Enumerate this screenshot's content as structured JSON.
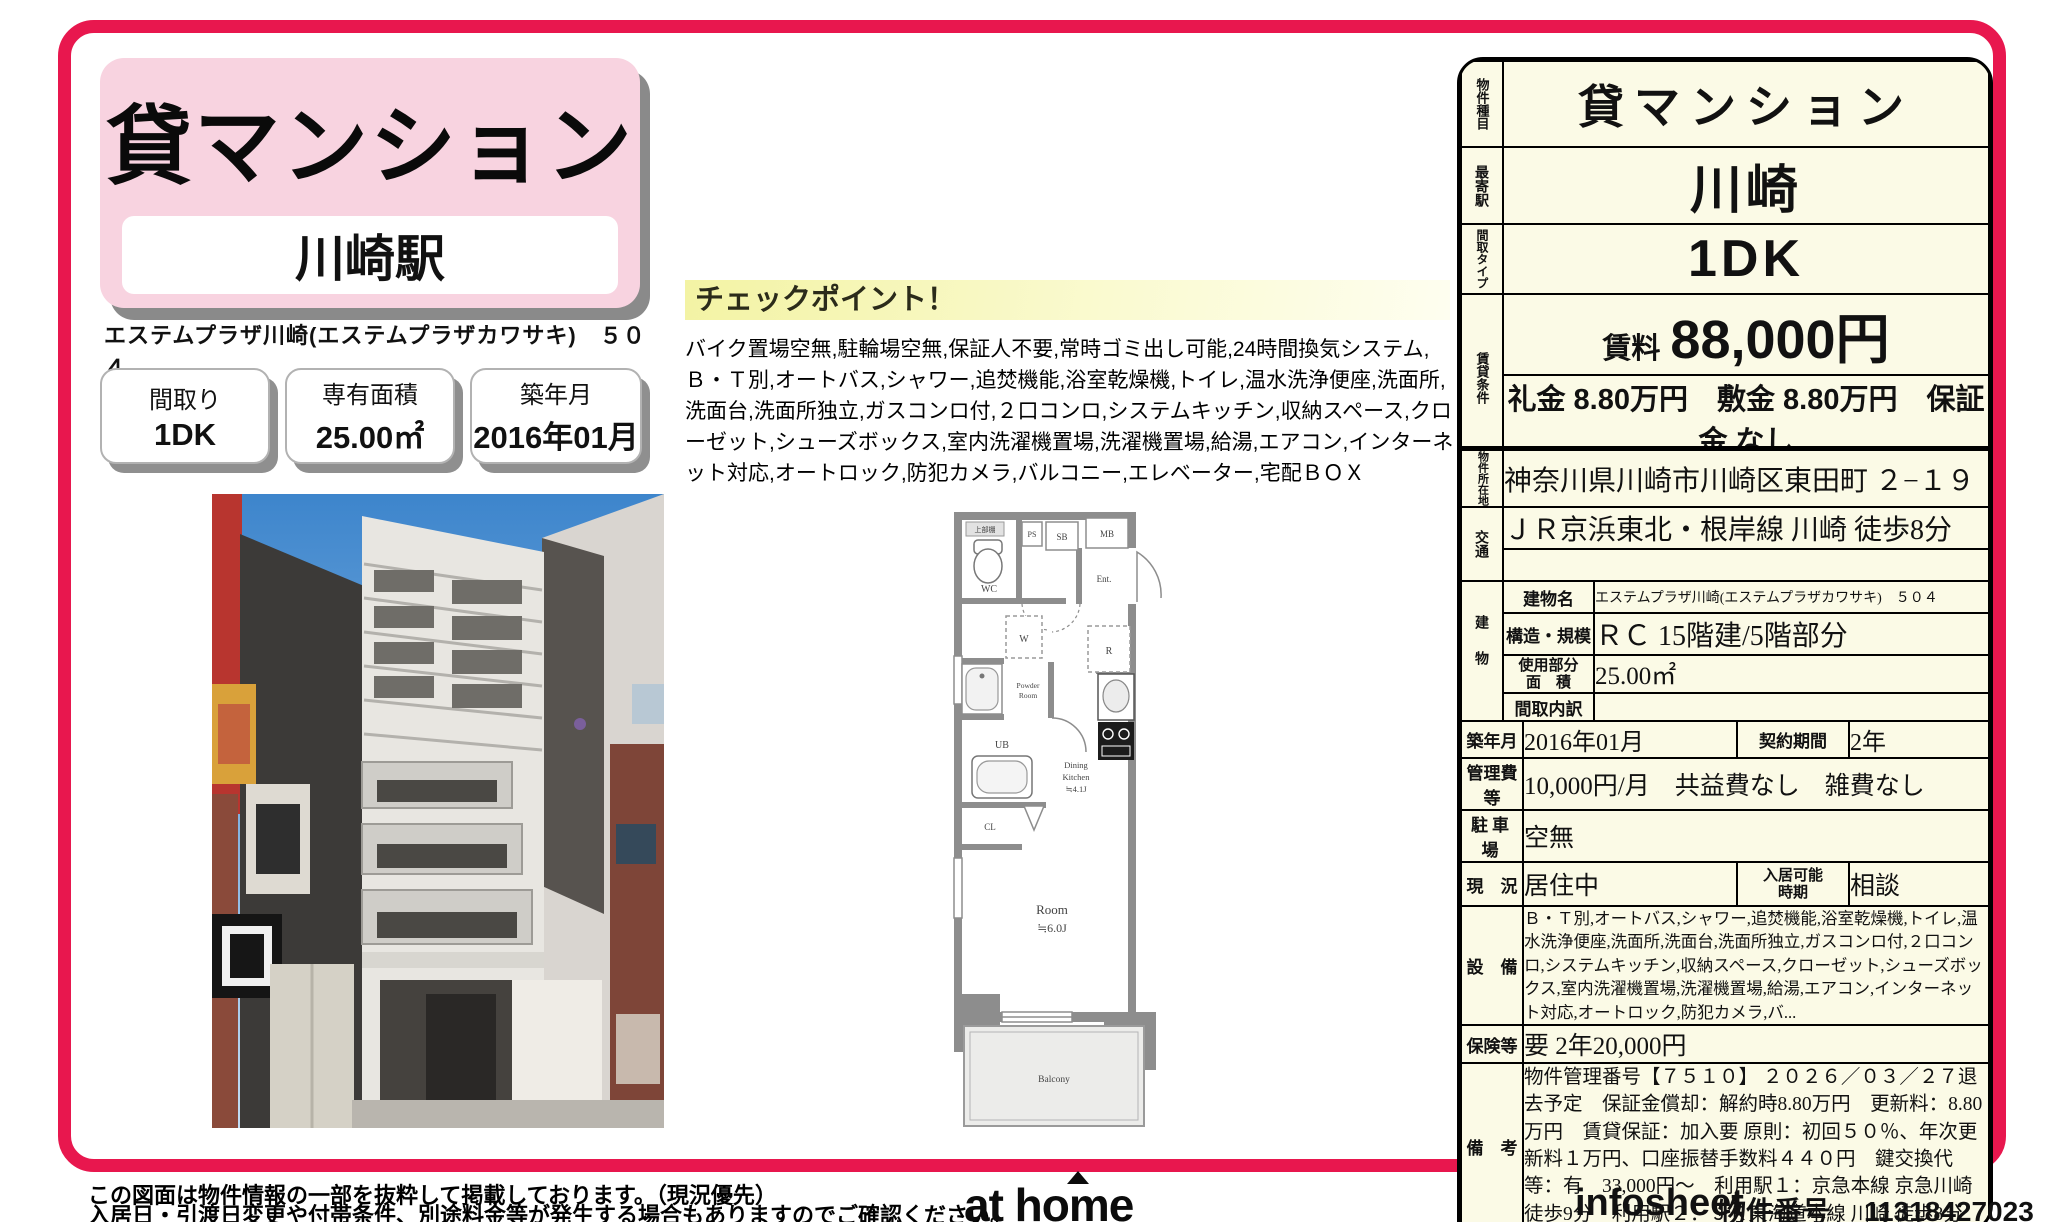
{
  "colors": {
    "accent": "#e8174e",
    "pink_card": "#f8d3e0",
    "pink_cell": "#f6cedd",
    "cream": "#fbfae6",
    "checkpoint_yellow": "#f4f4aa"
  },
  "header": {
    "property_type": "貸マンション",
    "station": "川崎駅",
    "building_name_line": "エステムプラザ川崎(エステムプラザカワサキ)　５０４"
  },
  "summary_boxes": [
    {
      "label": "間取り",
      "value": "1DK"
    },
    {
      "label": "専有面積",
      "value": "25.00㎡"
    },
    {
      "label": "築年月",
      "value": "2016年01月"
    }
  ],
  "checkpoint": {
    "title": "チェックポイント！",
    "body": "バイク置場空無,駐輪場空無,保証人不要,常時ゴミ出し可能,24時間換気システム,Ｂ・Ｔ別,オートバス,シャワー,追焚機能,浴室乾燥機,トイレ,温水洗浄便座,洗面所,洗面台,洗面所独立,ガスコンロ付,２口コンロ,システムキッチン,収納スペース,クローゼット,シューズボックス,室内洗濯機置場,洗濯機置場,給湯,エアコン,インターネット対応,オートロック,防犯カメラ,バルコニー,エレベーター,宅配ＢＯＸ"
  },
  "info": {
    "type_label": "物件種目",
    "type": "貸マンション",
    "station_label": "最寄駅",
    "station": "川崎",
    "layout_label": "間取タイプ",
    "layout": "1DK",
    "terms_label": "賃貸条件",
    "rent_label": "賃料",
    "rent": "88,000円",
    "fees": "礼金 8.80万円　敷金 8.80万円　保証金 なし"
  },
  "detail": {
    "location_label": "物件所在地",
    "location": "神奈川県川崎市川崎区東田町 ２−１９",
    "access_label": "交通",
    "access1": "ＪＲ京浜東北・根岸線 川崎 徒歩8分",
    "access2": "",
    "building_label": "建物",
    "bname_label": "建物名",
    "bname": "エステムプラザ川崎(エステムプラザカワサキ)　５０４",
    "structure_label": "構造・規模",
    "structure": "ＲＣ 15階建/5階部分",
    "area_label": "使用部分\n面　積",
    "area": "25.00㎡",
    "madori_label": "間取内訳",
    "madori": "",
    "built_label": "築年月",
    "built": "2016年01月",
    "contract_label": "契約期間",
    "contract": "2年",
    "mgmt_label": "管理費等",
    "mgmt": "10,000円/月　共益費なし　雑費なし",
    "parking_label": "駐車場",
    "parking": "空無",
    "status_label": "現　況",
    "status": "居住中",
    "movein_label": "入居可能\n時期",
    "movein": "相談",
    "equip_label": "設　備",
    "equip": "Ｂ・Ｔ別,オートバス,シャワー,追焚機能,浴室乾燥機,トイレ,温水洗浄便座,洗面所,洗面台,洗面所独立,ガスコンロ付,２口コンロ,システムキッチン,収納スペース,クローゼット,シューズボックス,室内洗濯機置場,洗濯機置場,給湯,エアコン,インターネット対応,オートロック,防犯カメラ,バ...",
    "insurance_label": "保険等",
    "insurance": "要 2年20,000円",
    "remarks_label": "備　考",
    "remarks": "物件管理番号【７５１０】 ２０２６／０３／２７退去予定　保証金償却：解約時8.80万円　更新料：8.80万円　賃貸保証：加入要 原則：初回５０％、年次更新料１万円、口座振替手数料４４０円　鍵交換代等：有　33,000円～　利用駅１：京急本線 京急川崎 徒歩9分　利用駅２：ＪＲ東海道本線 川崎 徒歩8分"
  },
  "floor_plan": {
    "shelf": "上部棚",
    "ps": "PS",
    "sb": "SB",
    "mb": "MB",
    "wc": "WC",
    "ent": "Ent.",
    "w": "W",
    "r": "R",
    "powder1": "Powder",
    "powder2": "Room",
    "ub": "UB",
    "cl": "CL",
    "dk1": "Dining",
    "dk2": "Kitchen",
    "dk3": "≒4.1J",
    "room1": "Room",
    "room2": "≒6.0J",
    "balcony": "Balcony"
  },
  "footer": {
    "note1": "この図面は物件情報の一部を抜粋して掲載しております。（現況優先）",
    "note2": "入居日・引渡日変更や付帯条件、別途料金等が発生する場合もありますのでご確認ください。",
    "logo": "at home",
    "infosheet_label": "infosheet",
    "property_no_label": "物件番号",
    "property_no": "11318427023"
  }
}
